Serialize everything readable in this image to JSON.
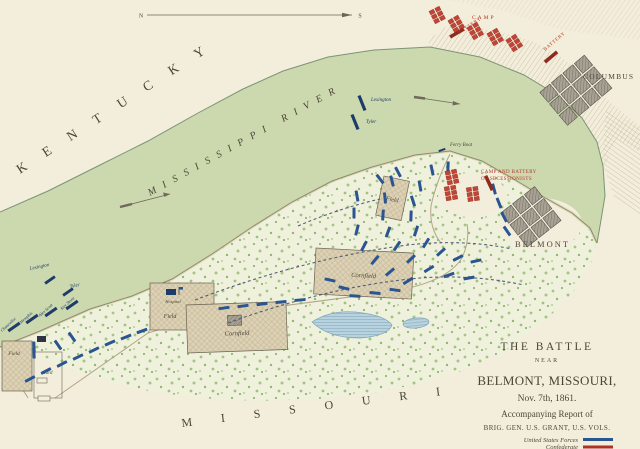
{
  "colors": {
    "paper": "#f3eedb",
    "river": "#ccd8ae",
    "shoreline": "#7d9474",
    "forest": "#f0f1dc",
    "union": "#2a5590",
    "union_dark": "#1d3c6a",
    "confed": "#c24435",
    "battery": "#8e2b1f",
    "red_text": "#b63627",
    "ink": "#4c4639",
    "town": "#9b968a",
    "field": "#ddd2b6",
    "pond": "#b9d3de",
    "road": "#b2a487"
  },
  "compass": {
    "north": "N",
    "south": "S"
  },
  "regions": {
    "kentucky": "KENTUCKY",
    "river": "MISSISSIPPI RIVER",
    "missouri": "MISSOURI"
  },
  "towns": {
    "columbus": "COLUMBUS",
    "belmont": "BELMONT"
  },
  "confederate_labels": {
    "camp": "CAMP",
    "battery_west": "BATTERY",
    "battery_east": "BATTERY",
    "secession_line1": "CAMP AND BATTERY",
    "secession_line2": "OF SECESSIONISTS"
  },
  "vessels": {
    "lexington_mid": "Lexington",
    "tyler_mid": "Tyler",
    "lexington_south": "Lexington",
    "tyler_south": "Tyler",
    "chancellor": "Chancellor",
    "memphis": "Memphis",
    "alex_scott": "Alex Scott",
    "key_stone": "Key Stone",
    "ferry_boat": "Ferry Boat"
  },
  "places": {
    "field_river": "Field",
    "cornfield_center": "Cornfield",
    "hospital": "Hospital",
    "field_hospital": "Field",
    "cornfield_west": "Cornfield",
    "field_sw": "Field",
    "yard": "Yard"
  },
  "title_block": {
    "line1": "THE BATTLE",
    "line2": "NEAR",
    "line3": "BELMONT, MISSOURI,",
    "line4": "Nov. 7th, 1861.",
    "line5": "Accompanying Report of",
    "line6": "BRIG. GEN. U.S. GRANT, U.S. VOLS.",
    "legend": [
      {
        "label": "United States Forces"
      },
      {
        "label": "Confederate"
      }
    ]
  },
  "map_markers": {
    "union_units": [
      [
        420,
        186,
        80
      ],
      [
        413,
        201,
        72
      ],
      [
        411,
        216,
        92
      ],
      [
        416,
        231,
        108
      ],
      [
        426,
        243,
        122
      ],
      [
        441,
        252,
        138
      ],
      [
        458,
        258,
        152
      ],
      [
        476,
        261,
        168
      ],
      [
        392,
        181,
        76
      ],
      [
        385,
        198,
        84
      ],
      [
        383,
        215,
        94
      ],
      [
        388,
        232,
        110
      ],
      [
        397,
        246,
        124
      ],
      [
        411,
        259,
        136
      ],
      [
        429,
        269,
        148
      ],
      [
        449,
        275,
        160
      ],
      [
        469,
        278,
        170
      ],
      [
        357,
        196,
        80
      ],
      [
        354,
        213,
        90
      ],
      [
        357,
        230,
        104
      ],
      [
        364,
        246,
        118
      ],
      [
        375,
        260,
        130
      ],
      [
        390,
        272,
        140
      ],
      [
        408,
        281,
        148
      ],
      [
        494,
        189,
        75
      ],
      [
        499,
        203,
        68
      ],
      [
        504,
        217,
        62
      ],
      [
        507,
        231,
        55
      ],
      [
        432,
        170,
        78
      ],
      [
        448,
        167,
        92
      ],
      [
        398,
        172,
        62
      ],
      [
        380,
        179,
        52
      ],
      [
        330,
        280,
        12
      ],
      [
        344,
        288,
        14
      ],
      [
        355,
        296,
        4
      ],
      [
        375,
        293,
        6
      ],
      [
        395,
        290,
        8
      ],
      [
        300,
        300,
        -5
      ],
      [
        281,
        302,
        -6
      ],
      [
        262,
        304,
        -7
      ],
      [
        243,
        306,
        -8
      ],
      [
        224,
        308,
        -8
      ],
      [
        30,
        379,
        -28
      ],
      [
        46,
        371,
        -28
      ],
      [
        62,
        364,
        -28
      ],
      [
        78,
        357,
        -26
      ],
      [
        94,
        350,
        -26
      ],
      [
        110,
        343,
        -24
      ],
      [
        126,
        337,
        -22
      ],
      [
        142,
        331,
        -20
      ],
      [
        58,
        345,
        55
      ],
      [
        72,
        337,
        55
      ],
      [
        34,
        347,
        88
      ],
      [
        34,
        353,
        88
      ]
    ],
    "confederate_camp_blocks": [
      [
        437,
        14,
        -27
      ],
      [
        456,
        23,
        -30
      ],
      [
        475,
        30,
        -30
      ],
      [
        495,
        36,
        -30
      ],
      [
        514,
        42,
        -33
      ],
      [
        452,
        176,
        -12
      ],
      [
        451,
        192,
        -10
      ],
      [
        473,
        193,
        -8
      ]
    ],
    "confederate_batteries": [
      [
        457,
        33,
        -30
      ],
      [
        551,
        57,
        -40
      ],
      [
        489,
        183,
        65
      ]
    ]
  }
}
